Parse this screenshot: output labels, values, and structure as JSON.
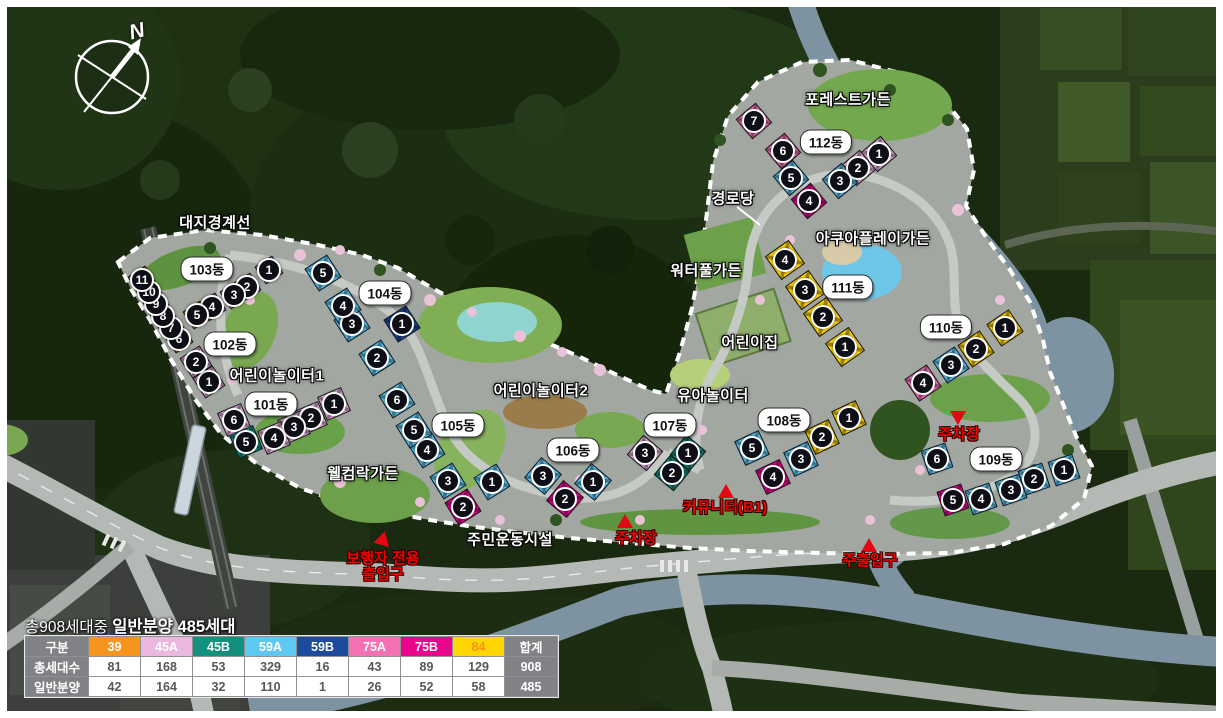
{
  "compass": {
    "north_label": "N"
  },
  "caption": {
    "prefix": "총908세대중 ",
    "highlight": "일반분양 485세대"
  },
  "unit_types": {
    "39": "#F7941D",
    "45A": "#ECB7DF",
    "45B": "#14917E",
    "59A": "#5FC8F2",
    "59B": "#1C4B9B",
    "75A": "#F472B4",
    "75B": "#EB038D",
    "84": "#FFD502"
  },
  "table": {
    "col_header_label": "구분",
    "total_label": "합계",
    "columns": [
      "39",
      "45A",
      "45B",
      "59A",
      "59B",
      "75A",
      "75B",
      "84"
    ],
    "header_text_colors": {
      "84": "#F7941D"
    },
    "rows": [
      {
        "label": "총세대수",
        "values": [
          "81",
          "168",
          "53",
          "329",
          "16",
          "43",
          "89",
          "129"
        ],
        "total": "908"
      },
      {
        "label": "일반분양",
        "values": [
          "42",
          "164",
          "32",
          "110",
          "1",
          "26",
          "52",
          "58"
        ],
        "total": "485"
      }
    ]
  },
  "buildings": [
    {
      "id": "103",
      "name": "103동",
      "label_x": 207,
      "label_y": 269,
      "angle": 57,
      "size": 21,
      "units": [
        {
          "no": 1,
          "type": "45A",
          "x": 269,
          "y": 270
        },
        {
          "no": 2,
          "type": "45A",
          "x": 247,
          "y": 287
        },
        {
          "no": 3,
          "type": "45A",
          "x": 234,
          "y": 295
        },
        {
          "no": 4,
          "type": "45A",
          "x": 212,
          "y": 307
        },
        {
          "no": 5,
          "type": "39",
          "x": 197,
          "y": 315
        },
        {
          "no": 6,
          "type": "39",
          "x": 179,
          "y": 339
        },
        {
          "no": 7,
          "type": "39",
          "x": 171,
          "y": 328
        },
        {
          "no": 8,
          "type": "39",
          "x": 163,
          "y": 316
        },
        {
          "no": 9,
          "type": "39",
          "x": 156,
          "y": 304
        },
        {
          "no": 10,
          "type": "39",
          "x": 149,
          "y": 292
        },
        {
          "no": 11,
          "type": "39",
          "x": 142,
          "y": 280
        }
      ]
    },
    {
      "id": "102",
      "name": "102동",
      "label_x": 230,
      "label_y": 344,
      "angle": 57,
      "size": 24,
      "units": [
        {
          "no": 1,
          "type": "45A",
          "x": 209,
          "y": 382
        },
        {
          "no": 2,
          "type": "45A",
          "x": 196,
          "y": 362
        }
      ]
    },
    {
      "id": "101",
      "name": "101동",
      "label_x": 271,
      "label_y": 404,
      "angle": -23,
      "size": 26,
      "units": [
        {
          "no": 1,
          "type": "45A",
          "x": 334,
          "y": 404
        },
        {
          "no": 2,
          "type": "45A",
          "x": 311,
          "y": 418
        },
        {
          "no": 3,
          "type": "45A",
          "x": 294,
          "y": 427
        },
        {
          "no": 4,
          "type": "45A",
          "x": 274,
          "y": 438
        },
        {
          "no": 5,
          "type": "45B",
          "x": 246,
          "y": 442
        },
        {
          "no": 6,
          "type": "45A",
          "x": 234,
          "y": 420
        }
      ]
    },
    {
      "id": "104",
      "name": "104동",
      "label_x": 385,
      "label_y": 293,
      "angle": 57,
      "size": 27,
      "units": [
        {
          "no": 1,
          "type": "59B",
          "x": 402,
          "y": 324
        },
        {
          "no": 2,
          "type": "59A",
          "x": 377,
          "y": 358
        },
        {
          "no": 3,
          "type": "59A",
          "x": 352,
          "y": 324
        },
        {
          "no": 4,
          "type": "59A",
          "x": 343,
          "y": 306
        },
        {
          "no": 5,
          "type": "59A",
          "x": 323,
          "y": 273
        }
      ]
    },
    {
      "id": "105",
      "name": "105동",
      "label_x": 458,
      "label_y": 425,
      "angle": 58,
      "size": 27,
      "units": [
        {
          "no": 1,
          "type": "59A",
          "x": 492,
          "y": 482
        },
        {
          "no": 2,
          "type": "75B",
          "x": 463,
          "y": 507
        },
        {
          "no": 3,
          "type": "59A",
          "x": 448,
          "y": 481
        },
        {
          "no": 4,
          "type": "59A",
          "x": 427,
          "y": 450
        },
        {
          "no": 5,
          "type": "59A",
          "x": 414,
          "y": 430
        },
        {
          "no": 6,
          "type": "59A",
          "x": 397,
          "y": 400
        }
      ]
    },
    {
      "id": "106",
      "name": "106동",
      "label_x": 573,
      "label_y": 450,
      "angle": 40,
      "size": 27,
      "units": [
        {
          "no": 1,
          "type": "59A",
          "x": 593,
          "y": 482
        },
        {
          "no": 2,
          "type": "75B",
          "x": 565,
          "y": 499
        },
        {
          "no": 3,
          "type": "59A",
          "x": 543,
          "y": 476
        }
      ]
    },
    {
      "id": "107",
      "name": "107동",
      "label_x": 670,
      "label_y": 425,
      "angle": 40,
      "size": 26,
      "units": [
        {
          "no": 1,
          "type": "45B",
          "x": 688,
          "y": 453
        },
        {
          "no": 2,
          "type": "45B",
          "x": 672,
          "y": 473
        },
        {
          "no": 3,
          "type": "45A",
          "x": 645,
          "y": 453
        }
      ]
    },
    {
      "id": "108",
      "name": "108동",
      "label_x": 784,
      "label_y": 420,
      "angle": -25,
      "size": 27,
      "units": [
        {
          "no": 1,
          "type": "84",
          "x": 849,
          "y": 418
        },
        {
          "no": 2,
          "type": "84",
          "x": 822,
          "y": 437
        },
        {
          "no": 3,
          "type": "59A",
          "x": 801,
          "y": 459
        },
        {
          "no": 4,
          "type": "75B",
          "x": 773,
          "y": 477
        },
        {
          "no": 5,
          "type": "59A",
          "x": 752,
          "y": 448
        }
      ]
    },
    {
      "id": "109",
      "name": "109동",
      "label_x": 996,
      "label_y": 459,
      "angle": -19,
      "size": 26,
      "units": [
        {
          "no": 1,
          "type": "59A",
          "x": 1064,
          "y": 470
        },
        {
          "no": 2,
          "type": "59A",
          "x": 1034,
          "y": 479
        },
        {
          "no": 3,
          "type": "59A",
          "x": 1011,
          "y": 490
        },
        {
          "no": 4,
          "type": "59A",
          "x": 981,
          "y": 499
        },
        {
          "no": 5,
          "type": "75B",
          "x": 953,
          "y": 500
        },
        {
          "no": 6,
          "type": "59A",
          "x": 937,
          "y": 459
        }
      ]
    },
    {
      "id": "110",
      "name": "110동",
      "label_x": 946,
      "label_y": 327,
      "angle": -34,
      "size": 27,
      "units": [
        {
          "no": 1,
          "type": "84",
          "x": 1005,
          "y": 328
        },
        {
          "no": 2,
          "type": "84",
          "x": 976,
          "y": 349
        },
        {
          "no": 3,
          "type": "59A",
          "x": 951,
          "y": 365
        },
        {
          "no": 4,
          "type": "75A",
          "x": 923,
          "y": 383
        }
      ]
    },
    {
      "id": "111",
      "name": "111동",
      "label_x": 848,
      "label_y": 287,
      "angle": 55,
      "size": 29,
      "units": [
        {
          "no": 1,
          "type": "84",
          "x": 845,
          "y": 347
        },
        {
          "no": 2,
          "type": "84",
          "x": 823,
          "y": 317
        },
        {
          "no": 3,
          "type": "84",
          "x": 805,
          "y": 290
        },
        {
          "no": 4,
          "type": "84",
          "x": 785,
          "y": 260
        }
      ]
    },
    {
      "id": "112",
      "name": "112동",
      "label_x": 826,
      "label_y": 142,
      "angle": -40,
      "size": 26,
      "units": [
        {
          "no": 1,
          "type": "45A",
          "x": 879,
          "y": 154
        },
        {
          "no": 2,
          "type": "45A",
          "x": 858,
          "y": 168
        },
        {
          "no": 3,
          "type": "59A",
          "x": 840,
          "y": 181
        },
        {
          "no": 4,
          "type": "75B",
          "x": 809,
          "y": 201
        },
        {
          "no": 5,
          "type": "59A",
          "x": 791,
          "y": 178
        },
        {
          "no": 6,
          "type": "75A",
          "x": 783,
          "y": 151
        },
        {
          "no": 7,
          "type": "75A",
          "x": 754,
          "y": 121
        }
      ]
    }
  ],
  "area_labels": [
    {
      "text": "대지경계선",
      "x": 215,
      "y": 222
    },
    {
      "text": "어린이놀이터1",
      "x": 277,
      "y": 375
    },
    {
      "text": "어린이놀이터2",
      "x": 541,
      "y": 390
    },
    {
      "text": "웰컴락가든",
      "x": 363,
      "y": 473
    },
    {
      "text": "주민운동시설",
      "x": 510,
      "y": 539
    },
    {
      "text": "유아놀이터",
      "x": 713,
      "y": 395
    },
    {
      "text": "어린이집",
      "x": 750,
      "y": 342
    },
    {
      "text": "워터풀가든",
      "x": 706,
      "y": 270
    },
    {
      "text": "경로당",
      "x": 733,
      "y": 198
    },
    {
      "text": "아쿠아플레이가든",
      "x": 873,
      "y": 238
    },
    {
      "text": "포레스트가든",
      "x": 848,
      "y": 99
    }
  ],
  "poi_markers": [
    {
      "lines": [
        "보행자 전용",
        "출입구"
      ],
      "x": 383,
      "y": 551,
      "tri_x": 384,
      "tri_y": 542,
      "dir": "down-right"
    },
    {
      "lines": [
        "주차장"
      ],
      "x": 636,
      "y": 531,
      "tri_x": 625,
      "tri_y": 521,
      "dir": "up"
    },
    {
      "lines": [
        "커뮤니티(B1)"
      ],
      "x": 725,
      "y": 500,
      "tri_x": 726,
      "tri_y": 491,
      "dir": "up"
    },
    {
      "lines": [
        "주출입구"
      ],
      "x": 870,
      "y": 553,
      "tri_x": 869,
      "tri_y": 545,
      "dir": "up"
    },
    {
      "lines": [
        "주차장"
      ],
      "x": 959,
      "y": 427,
      "tri_x": 958,
      "tri_y": 418,
      "dir": "down"
    }
  ]
}
